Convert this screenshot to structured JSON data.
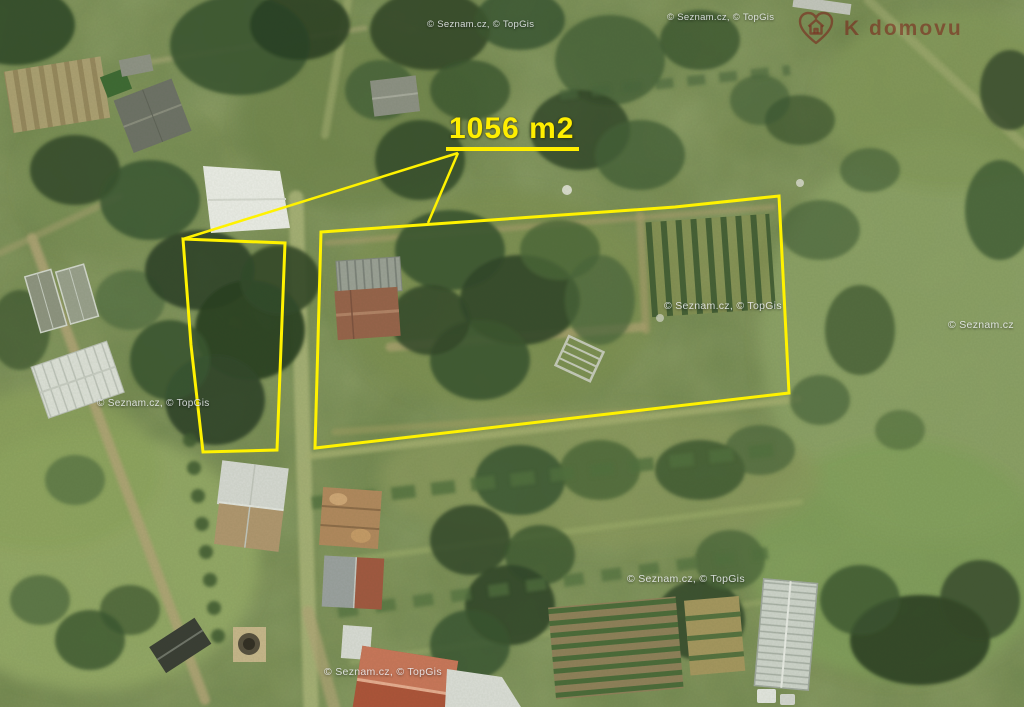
{
  "map": {
    "description": "Aerial photo of allotment garden plots with highlighted parcel",
    "area_label": "1056 m2",
    "outline_color": "#fff200",
    "plot_main_points": "321,232 675,207 779,196 789,393 315,448",
    "plot_secondary_points": "183,239 285,243 277,450 203,452 191,345",
    "leader_line_1": "M458,153 L183,239",
    "leader_line_2": "M458,153 L428,223"
  },
  "watermarks": [
    {
      "text": "© Seznam.cz, © TopGis"
    },
    {
      "text": "© Seznam.cz, © TopGis"
    },
    {
      "text": "© Seznam.cz, © TopGis"
    },
    {
      "text": "© Seznam.cz"
    },
    {
      "text": "© Seznam.cz, © TopGis"
    },
    {
      "text": "© Seznam.cz, © TopGis"
    },
    {
      "text": "© Seznam.cz, © TopGis"
    }
  ],
  "logo": {
    "text": "K domovu",
    "color": "#7a1c16",
    "icon": "heart-house-icon"
  }
}
